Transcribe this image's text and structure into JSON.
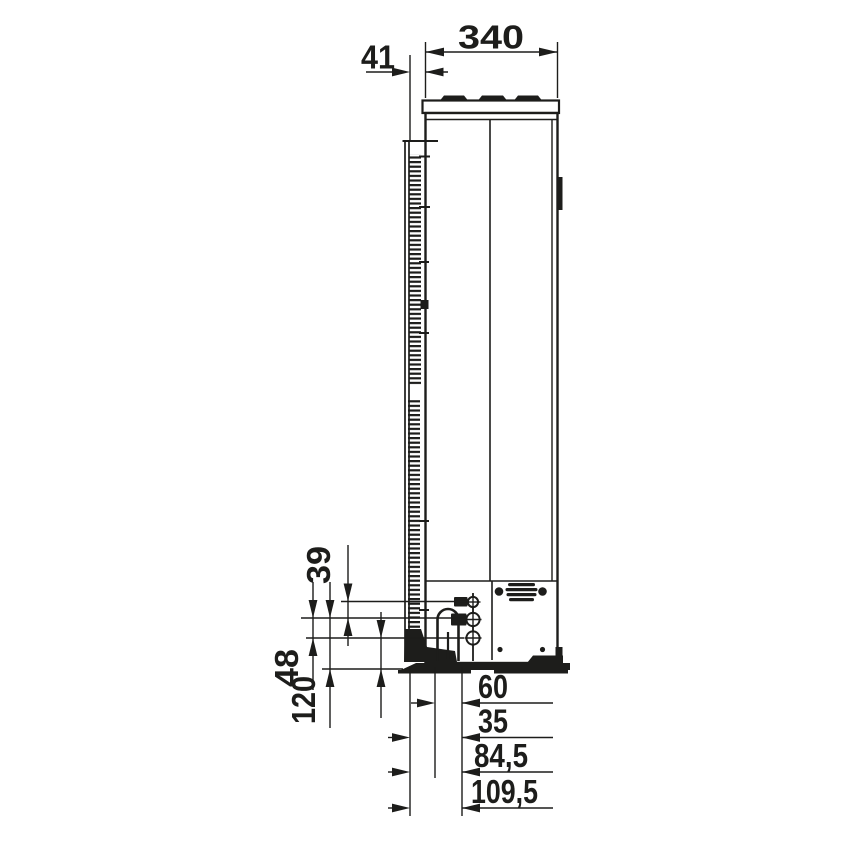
{
  "figure": {
    "kind": "technical-dimension-drawing",
    "view": "side-view-outdoor-unit"
  },
  "colors": {
    "line": "#1d1d1b",
    "background": "#ffffff"
  },
  "dimensions": {
    "top": [
      "340",
      "41"
    ],
    "left": [
      "39",
      "48",
      "120"
    ],
    "bottom": [
      "60",
      "35",
      "84,5",
      "109,5"
    ]
  }
}
